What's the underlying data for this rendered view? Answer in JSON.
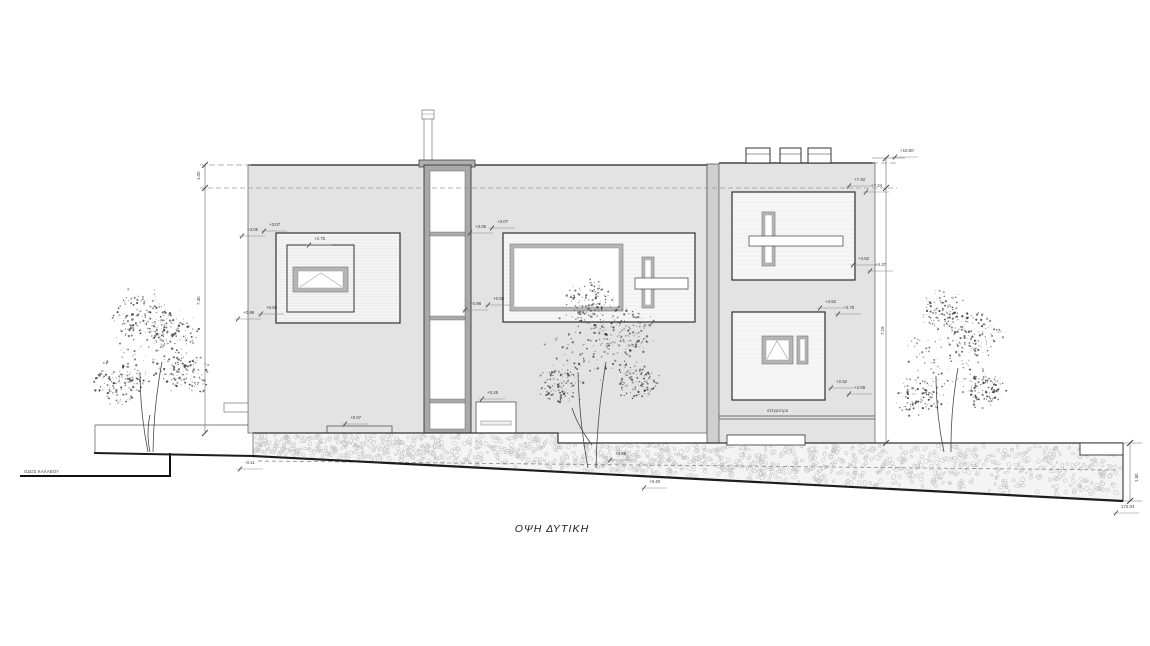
{
  "title": "ΟΨΗ ΔΥΤΙΚΗ",
  "labels": {
    "street": "ΟΔΟΣ ΚΑΛΑΒΟΥ",
    "canopy": "στέγαστρο",
    "corner_elevation": "172.04"
  },
  "colors": {
    "wall": "#e3e3e3",
    "divider": "#cfcfcf",
    "window_bg": "#f6f6f6",
    "frame": "#b5b5b5",
    "outline": "#2f2f2f",
    "hatch_bg": "#f4f4f4",
    "tree_ink": "#333333"
  },
  "annotations": [
    {
      "x": 247,
      "y": 231,
      "text": "+3.05"
    },
    {
      "x": 269,
      "y": 226,
      "text": "+3.07"
    },
    {
      "x": 314,
      "y": 240,
      "text": "+2.75"
    },
    {
      "x": 243,
      "y": 314,
      "text": "+0.98"
    },
    {
      "x": 266,
      "y": 309,
      "text": "+0.58"
    },
    {
      "x": 475,
      "y": 228,
      "text": "+3.05"
    },
    {
      "x": 497,
      "y": 223,
      "text": "+3.07"
    },
    {
      "x": 470,
      "y": 305,
      "text": "+0.98"
    },
    {
      "x": 493,
      "y": 300,
      "text": "+0.58"
    },
    {
      "x": 487,
      "y": 394,
      "text": "+0.25"
    },
    {
      "x": 350,
      "y": 419,
      "text": "+0.07"
    },
    {
      "x": 900,
      "y": 152,
      "text": "+10.60"
    },
    {
      "x": 854,
      "y": 181,
      "text": "+7.40"
    },
    {
      "x": 871,
      "y": 187,
      "text": "+7.24"
    },
    {
      "x": 858,
      "y": 260,
      "text": "+4.52"
    },
    {
      "x": 875,
      "y": 266,
      "text": "+4.37"
    },
    {
      "x": 825,
      "y": 303,
      "text": "+4.52"
    },
    {
      "x": 843,
      "y": 309,
      "text": "+3.78"
    },
    {
      "x": 836,
      "y": 383,
      "text": "+2.52"
    },
    {
      "x": 854,
      "y": 389,
      "text": "+2.08"
    },
    {
      "x": 615,
      "y": 455,
      "text": "+0.65"
    },
    {
      "x": 649,
      "y": 483,
      "text": "+0.40"
    },
    {
      "x": 245,
      "y": 464,
      "text": "-0.11"
    },
    {
      "x": 1121,
      "y": 508,
      "text": "172.04"
    },
    {
      "x": 200,
      "y": 180,
      "text": "1.00",
      "rot": -90
    },
    {
      "x": 200,
      "y": 305,
      "text": "7.40",
      "rot": -90
    },
    {
      "x": 884,
      "y": 335,
      "text": "7.18",
      "rot": -90
    },
    {
      "x": 1138,
      "y": 482,
      "text": "1.50",
      "rot": -90
    }
  ]
}
